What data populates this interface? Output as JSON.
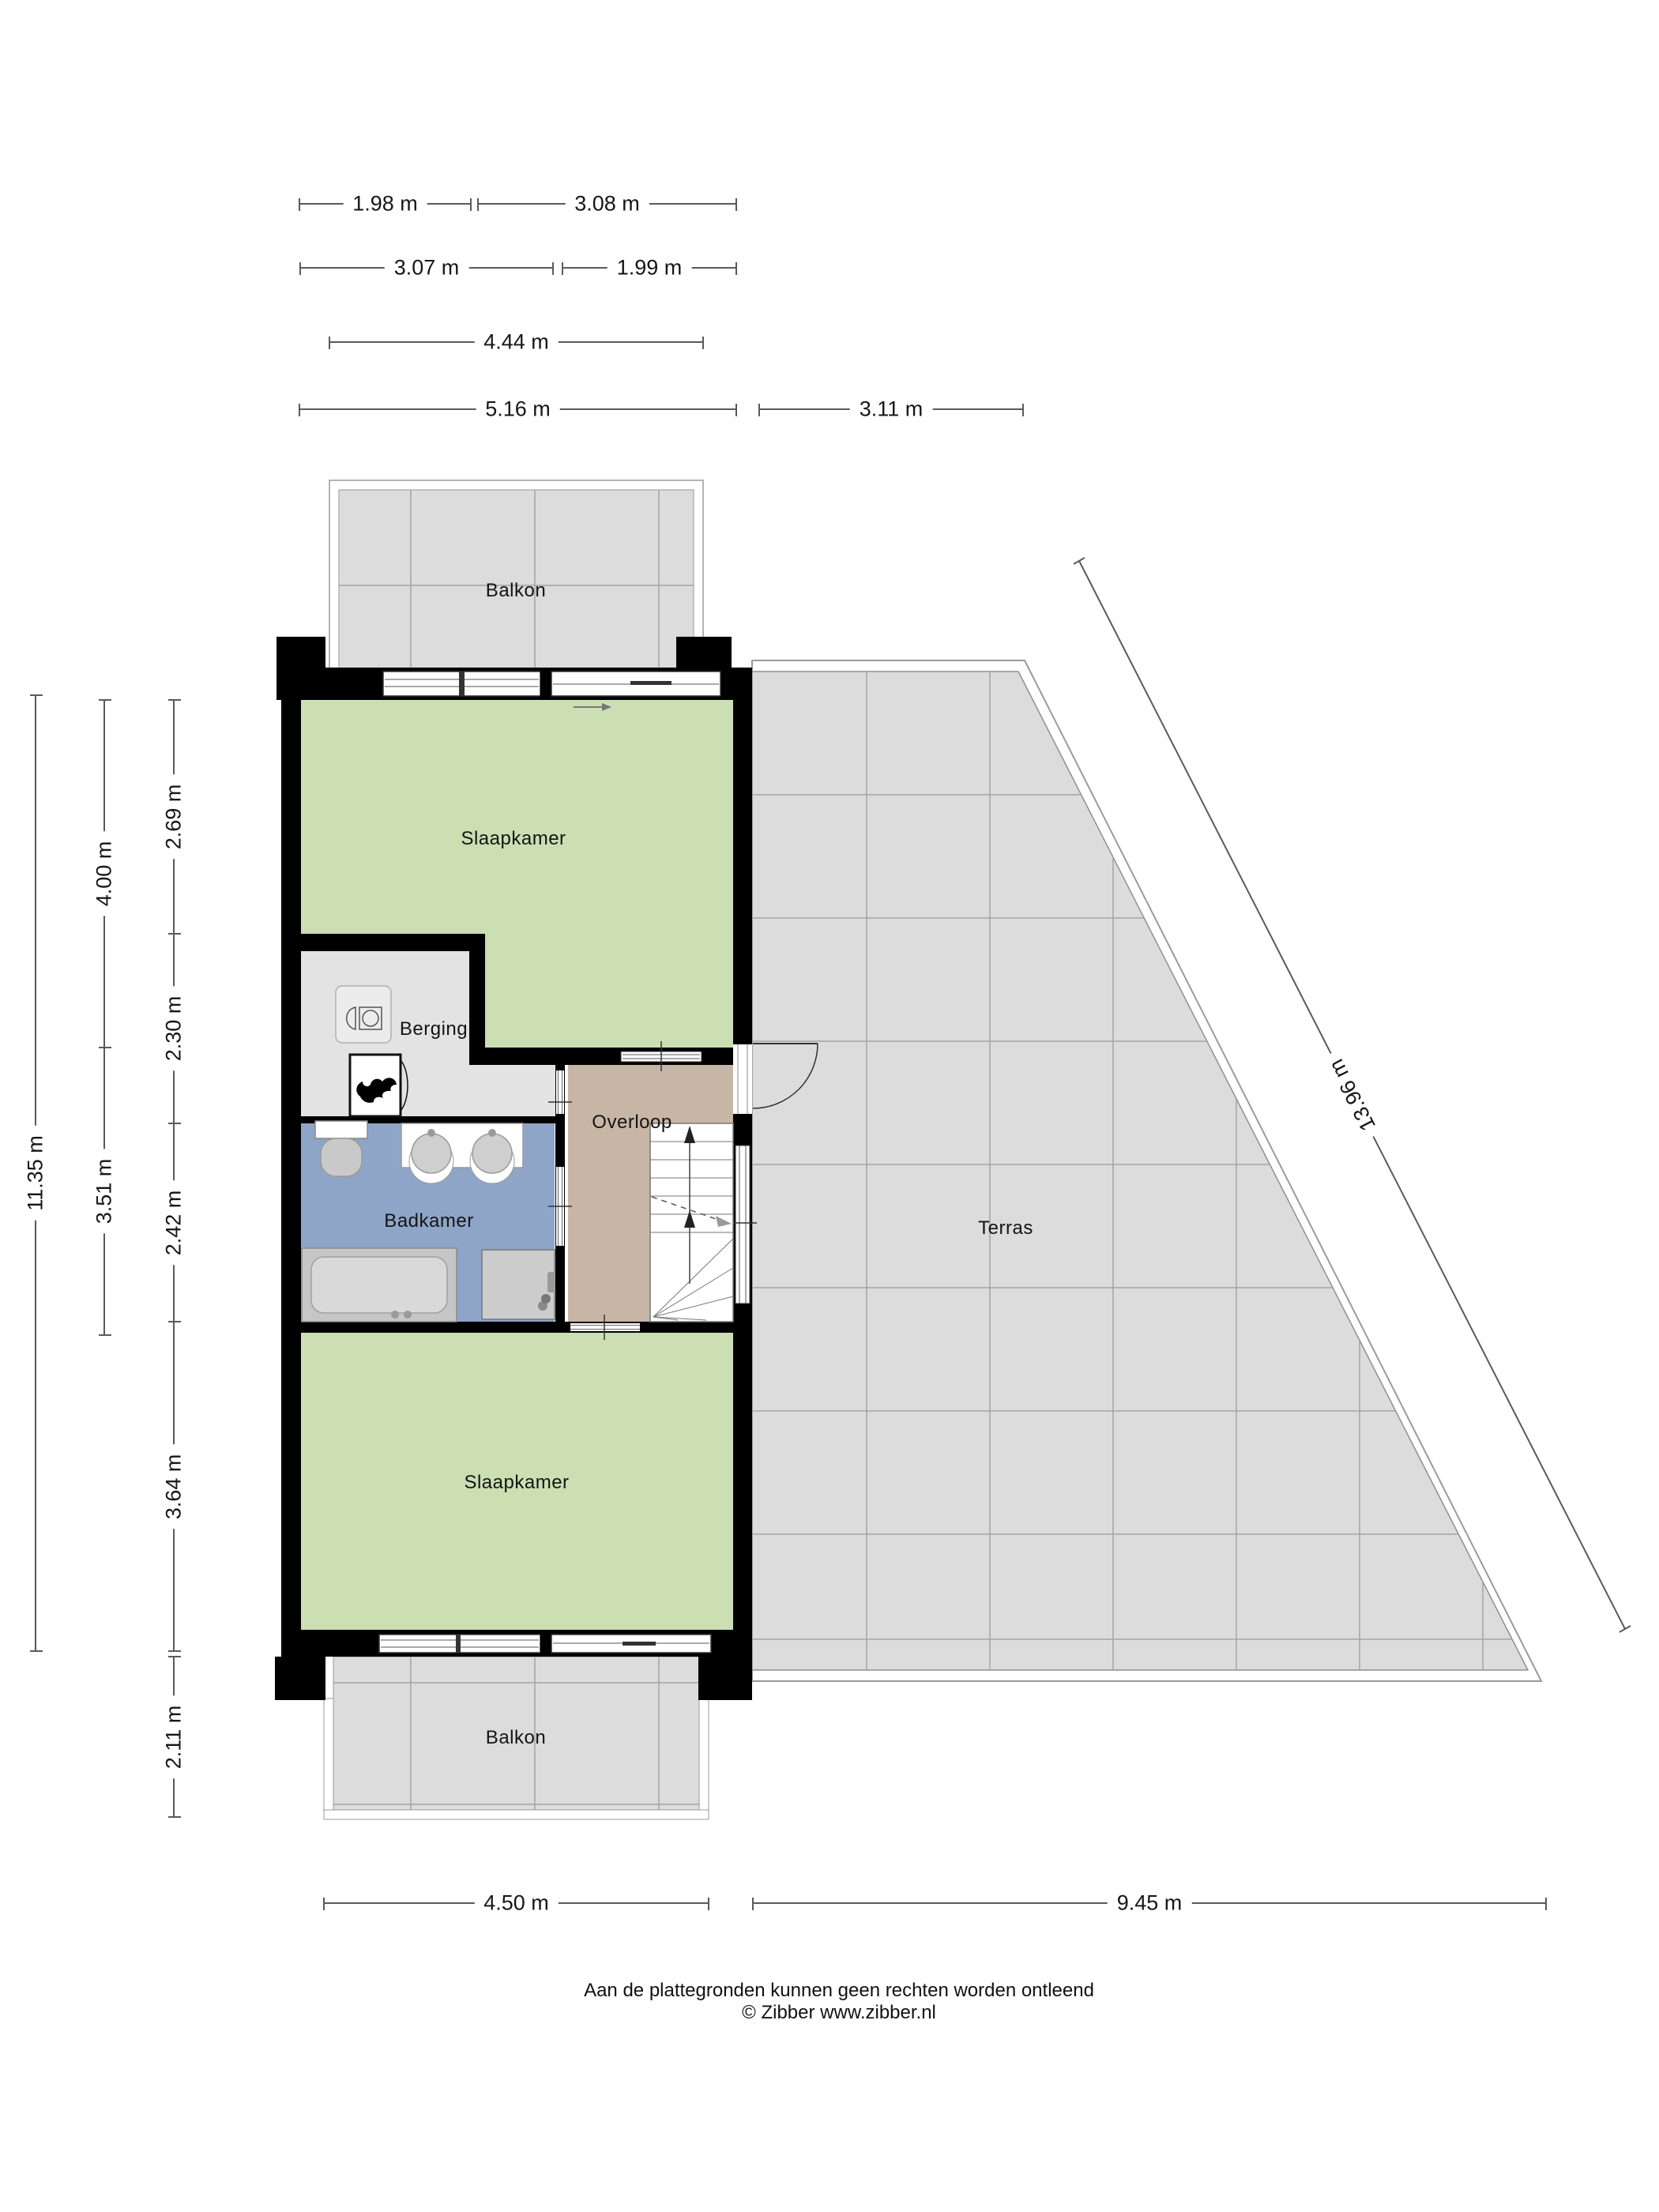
{
  "rooms": {
    "balkon_top": "Balkon",
    "slaapkamer_top": "Slaapkamer",
    "berging": "Berging",
    "overloop": "Overloop",
    "badkamer": "Badkamer",
    "terras": "Terras",
    "slaapkamer_bottom": "Slaapkamer",
    "balkon_bottom": "Balkon"
  },
  "dimensions": {
    "top": [
      {
        "label": "1.98 m"
      },
      {
        "label": "3.08 m"
      },
      {
        "label": "3.07 m"
      },
      {
        "label": "1.99 m"
      },
      {
        "label": "4.44 m"
      },
      {
        "label": "5.16 m"
      },
      {
        "label": "3.11 m"
      }
    ],
    "left": [
      {
        "label": "11.35 m"
      },
      {
        "label": "4.00 m"
      },
      {
        "label": "3.51 m"
      },
      {
        "label": "2.69 m"
      },
      {
        "label": "2.30 m"
      },
      {
        "label": "2.42 m"
      },
      {
        "label": "3.64 m"
      },
      {
        "label": "2.11 m"
      }
    ],
    "bottom": [
      {
        "label": "4.50 m"
      },
      {
        "label": "9.45 m"
      }
    ],
    "diagonal": [
      {
        "label": "13.96 m"
      }
    ]
  },
  "footer": {
    "line1": "Aan de plattegronden kunnen geen rechten worden ontleend",
    "line2": "© Zibber www.zibber.nl"
  },
  "colors": {
    "wall": "#000000",
    "room_green": "#cbdfb3",
    "overloop_tan": "#c7b5a6",
    "badkamer_blue": "#8fa5c8",
    "tile_gray": "#dcdcdc",
    "berging_gray": "#e3e3e3"
  }
}
